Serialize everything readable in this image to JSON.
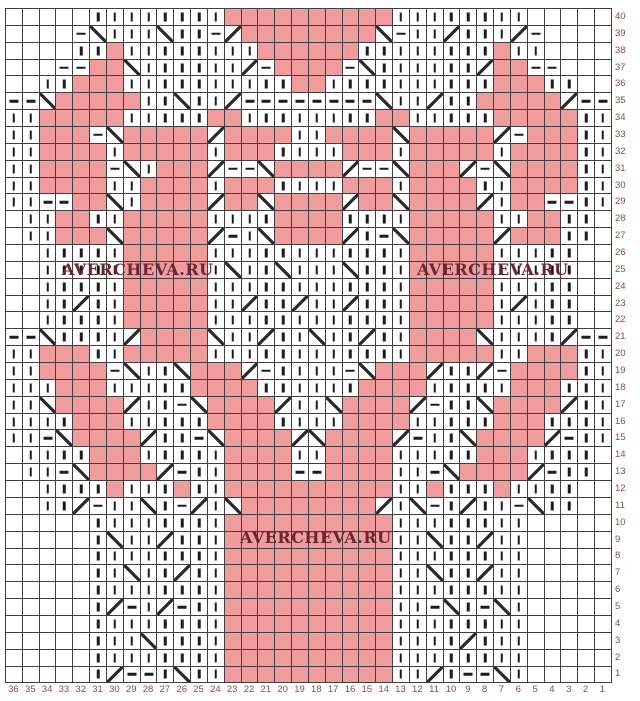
{
  "chart_title": "knitting stitch chart",
  "watermark": {
    "text": "AVERCHEVA.RU",
    "placements": [
      {
        "name": "left-middle",
        "left": 62,
        "top": 260
      },
      {
        "name": "right-middle",
        "left": 417,
        "top": 260
      },
      {
        "name": "bottom-center",
        "left": 240,
        "top": 528
      }
    ]
  },
  "grid": {
    "columns": 36,
    "rows": 40,
    "row_labels": [
      "40",
      "39",
      "38",
      "37",
      "36",
      "35",
      "34",
      "33",
      "32",
      "31",
      "30",
      "29",
      "28",
      "27",
      "26",
      "25",
      "24",
      "23",
      "22",
      "21",
      "20",
      "19",
      "18",
      "17",
      "16",
      "15",
      "14",
      "13",
      "12",
      "11",
      "10",
      "9",
      "8",
      "7",
      "6",
      "5",
      "4",
      "3",
      "2",
      "1"
    ],
    "col_labels": [
      "36",
      "35",
      "34",
      "33",
      "32",
      "31",
      "30",
      "29",
      "28",
      "27",
      "26",
      "25",
      "24",
      "23",
      "22",
      "21",
      "20",
      "19",
      "18",
      "17",
      "16",
      "15",
      "14",
      "13",
      "12",
      "11",
      "10",
      "9",
      "8",
      "7",
      "6",
      "5",
      "4",
      "3",
      "2",
      "1"
    ]
  },
  "colors": {
    "pink": "#f09c9e",
    "grid_line": "#3f3f3f",
    "symbol": "#1c1c1c",
    "label": "#8a4a42",
    "watermark": "#6b2630",
    "background": "#ffffff"
  },
  "legend": {
    "I": "knit stitch (vertical bar)",
    "-": "purl stitch (dash)",
    "/": "cable line rising",
    "\\": "cable line falling",
    "P": "pink (pattern motif cell)",
    ".": "empty cell"
  },
  "pattern": {
    "rows": [
      ".....IIIIIIIIPPPPPPPPPPIIIIIIII.....",
      "....-/III/II-\\PPPPPPPP/-II\\III\\-....",
      "....IIPIIIIIIIIPPPPPPIIIIIIIIPII....",
      "...--PP/IIIIII\\-PPPP-/IIIIII\\PP--...",
      "..IIPPPIIIIIIIIIIPPIIIIIIIIIIPPPII..",
      "--/PPPPPII/II\\--------/II\\IIPPPPP\\--",
      "IIPPPPPIIIIIPPIIIIIIIIPPIIIIIPPPPPII",
      "IIPPP-/PPPPP\\PPPPIIPPPP/PPPPP\\-PPPII",
      "IIPPPPIPPPPPIPPPIIIIPPPIPPPPPIPPPPII",
      "IIPPPP-/IPPP\\--/PPPP\\--/PPP\\-/PPPPII",
      "IIPPPPIIPPPPIPPPIIIIPPPIPPPPIIPPPPII",
      "II--PP/IPPPP\\PP/PPPP\\PP/PPPP\\IPP--II",
      ".IIPPIIPPPPPIIIIPPPPIIIIPPPPPIIPPII.",
      ".IIPPP/PPPPP\\-I/PPPP\\I-/PPPPP\\PPPII.",
      "..IIIIIPPPPPIIIIIIIIIIIIPPPPPIIIII..",
      "..IIIIIPPPPPI/II/III/IIIPPPPPIIIII..",
      "..IIIIIPPPPPIIIIIIIIIIIIPPPPPIIIII..",
      "..II\\IIPPPPPII\\II\\II\\IIIPPPPPI\\III..",
      "..IIIIIPPPPPIIIIIIIIIIIIPPPPPIIIII..",
      "--/IIII\\PPPP/II\\II/II\\IIPPPP/IIII\\--",
      "IIPPPIIPPPPPIIIIIIIIIIIIPPPPPIIPPPII",
      "IIPPPP-/II/PPP\\-IIII-/PPP\\II\\-PPPPII",
      "IIIPPPIIIIIPPPPIIIIIIPPPPIIIIIPPPIII",
      "II/PPPP\\II-/PPPP\\II/PPPP\\-II/PPPP\\II",
      "IIIIPPPIIIIIPPPPIIIIPPPPIIIIIPPPIIII",
      "II-/PPPP\\II-/PPPP\\/PPPP\\-II/PPPP\\-II",
      ".IIIIPPPIIIIIPPPPIIPPPPIIIIIPPPIIII.",
      ".II-/PPPP\\-IIPPPP--PPPPII-/PPPP\\-II.",
      "..IIIIPIIIPIIPPPPPPPPPPIIPIIIPIIII..",
      "..II\\-II/I-\\I/PPPPPPPP\\I/-I\\II-/II..",
      ".....IIIIIIIIPPPPPPPPPPIIIIIIII.....",
      ".....I/II\\IIIPPPPPPPPPPII/II\\II.....",
      ".....IIIIIIIIPPPPPPPPPPIIIIIIII.....",
      ".....II/II\\IIPPPPPPPPPPII/II\\II.....",
      ".....IIIIIIIIPPPPPPPPPPIIIIIIII.....",
      ".....I\\-I\\-IIPPPPPPPPPPII-/I-/I.....",
      ".....IIIIIIIIPPPPPPPPPPIIIIIIII.....",
      ".....III/IIIIPPPPPPPPPPIIII\\III.....",
      ".....IIIIIIIIPPPPPPPPPPIIIIIIII.....",
      ".....I\\--I/IIPPPPPPPPPPII\\I--/I....."
    ]
  }
}
